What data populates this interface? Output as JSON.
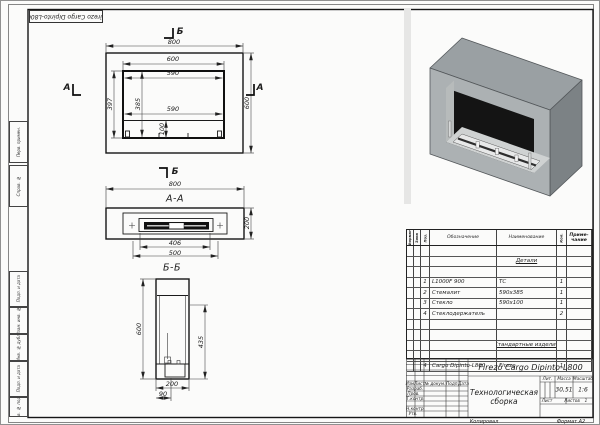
{
  "sheet": {
    "top_stamp": "Firezo Cargo Dipinto-L800",
    "copy_label": "Копировал",
    "format_label": "Формат А2",
    "margin_stamps": [
      "Перв. примен.",
      "Справ. №",
      "Подп. и дата",
      "Взам. инв. №",
      "Инв. № дубл.",
      "Подп. и дата",
      "Инв. № подл."
    ]
  },
  "views": {
    "front": {
      "section_letter_a": "А",
      "section_letter_b": "Б",
      "dim_width": "800",
      "dim_height": "600",
      "dim_opening": "600",
      "dim_glass_w1": "590",
      "dim_glass_w2": "590",
      "dim_inner_h": "397",
      "dim_glass_h": "385",
      "dim_burner_h": "100"
    },
    "aa": {
      "label": "А-А",
      "dim_width": "800",
      "dim_depth": "200",
      "dim_burner": "406",
      "dim_tray": "500"
    },
    "bb": {
      "label": "Б-Б",
      "dim_height": "600",
      "dim_front_h": "435",
      "dim_depth": "200",
      "dim_offset": "90"
    }
  },
  "spec": {
    "col_format": "Формат",
    "col_zone": "Зона",
    "col_pos": "Поз.",
    "col_desig": "Обозначение",
    "col_name": "Наименование",
    "col_qty": "Кол.",
    "col_note1": "Приме-",
    "col_note2": "чание",
    "group1": "Детали",
    "group2": "Стандартные изделия",
    "rows": [
      {
        "pos": "1",
        "desig": "L1000F 900",
        "name": "ТС",
        "qty": "1"
      },
      {
        "pos": "2",
        "desig": "Стемалит",
        "name": "590х385",
        "qty": "1"
      },
      {
        "pos": "3",
        "desig": "Стекло",
        "name": "590х100",
        "qty": "1"
      },
      {
        "pos": "4",
        "desig": "Стеклодержатель",
        "name": "",
        "qty": "2"
      },
      {
        "pos": "4",
        "desig": "Cargo Dipinto-L800",
        "name": "Firezo",
        "qty": "1"
      }
    ]
  },
  "title_block": {
    "designation": "Firezo Cargo Dipinto-L800",
    "title_line1": "Технологическая",
    "title_line2": "сборка",
    "col_izm": "Изм.",
    "col_list": "Лист",
    "col_doc": "№ докум.",
    "col_sign": "Подп.",
    "col_date": "Дата",
    "row_razrab": "Разраб.",
    "row_prov": "Пров.",
    "row_tkontr": "Т.контр.",
    "row_nkontr": "Н.контр.",
    "row_utv": "Утв.",
    "lit_label": "Лит.",
    "mass_label": "Масса",
    "scale_label": "Масштаб",
    "mass": "30,51",
    "scale": "1:6",
    "sheet_label": "Лист",
    "sheets_label": "Листов",
    "sheets_value": "1"
  }
}
